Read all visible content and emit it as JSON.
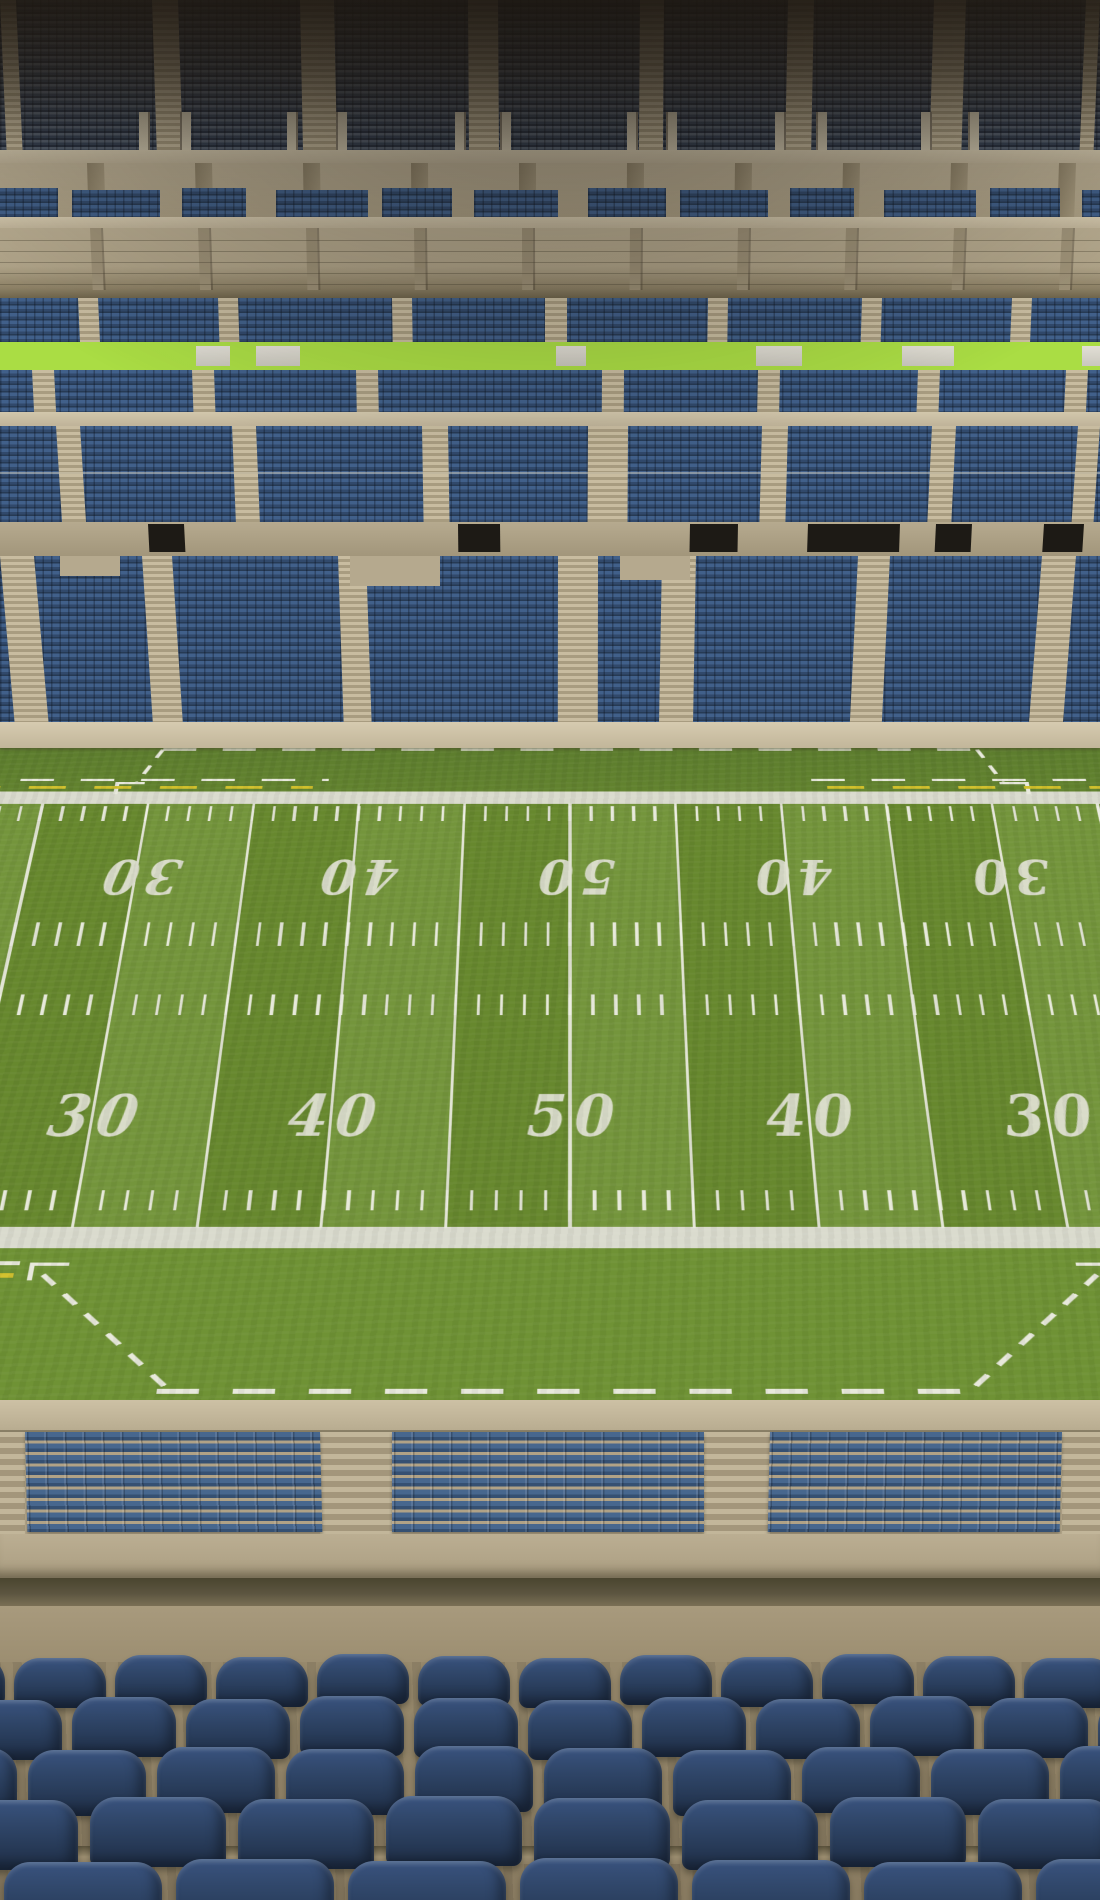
{
  "scene": {
    "label": "Empty football stadium — view from seats behind the sideline"
  },
  "field": {
    "top_numbers": [
      "20",
      "30",
      "40",
      "50",
      "40",
      "30",
      "20"
    ],
    "bottom_numbers": [
      "30",
      "40",
      "50",
      "40",
      "30"
    ],
    "colors": {
      "stripe_light": "#74953c",
      "stripe_dark": "#67882e",
      "far_apron": "#5c7c2e",
      "near_apron": "#6f9235",
      "sideline_white": "#dadbce",
      "line_white": "#e8e9dc",
      "restraining_yellow": "#d2c12b"
    }
  },
  "stands": {
    "seat_blue": "#3a5a80",
    "seat_blue_dark": "#2c4158",
    "upper_deck_shadow": "#2a221b",
    "concrete_light": "#d0c5aa",
    "concrete_mid": "#b5a98e",
    "concrete_dark": "#9a8e74",
    "lower_block_count": 3,
    "tier_names": [
      "upper-deck",
      "loge-level",
      "terrace-concourse",
      "mid-tier-1",
      "mid-tier-2",
      "mid-tier-3",
      "lower-tier"
    ]
  },
  "foreground": {
    "rows": 5,
    "seat_color": "#2e4460",
    "floor_color": "#8d7f67",
    "walkway_color": "#a59876"
  }
}
